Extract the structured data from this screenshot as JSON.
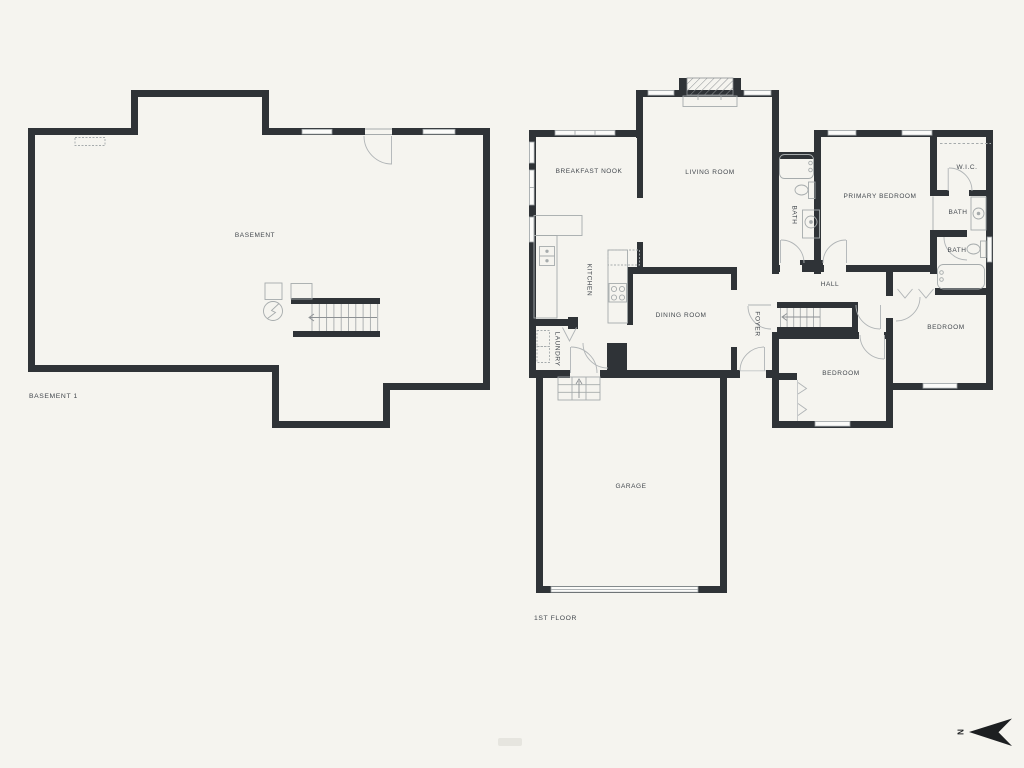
{
  "palette": {
    "background": "#f5f4ef",
    "wall": "#2f3337",
    "fixture_line": "#a6abac",
    "door_line": "#b0b4b6",
    "window_fill": "#fbfbf9",
    "text": "#43484e",
    "north_arrow": "#1d1f21"
  },
  "basement": {
    "floor_label": "BASEMENT 1",
    "rooms": {
      "basement": "BASEMENT"
    }
  },
  "first_floor": {
    "floor_label": "1ST FLOOR",
    "rooms": {
      "breakfast_nook": "BREAKFAST NOOK",
      "living_room": "LIVING ROOM",
      "kitchen": "KITCHEN",
      "dining_room": "DINING ROOM",
      "laundry": "LAUNDRY",
      "foyer": "FOYER",
      "hall": "HALL",
      "garage": "GARAGE",
      "primary_bedroom": "PRIMARY BEDROOM",
      "wic": "W.I.C.",
      "bath_primary": "BATH",
      "bath_vanity": "BATH",
      "bath_hall": "BATH",
      "bedroom_rear": "BEDROOM",
      "bedroom_front": "BEDROOM"
    }
  },
  "compass": {
    "north_label": "N"
  }
}
